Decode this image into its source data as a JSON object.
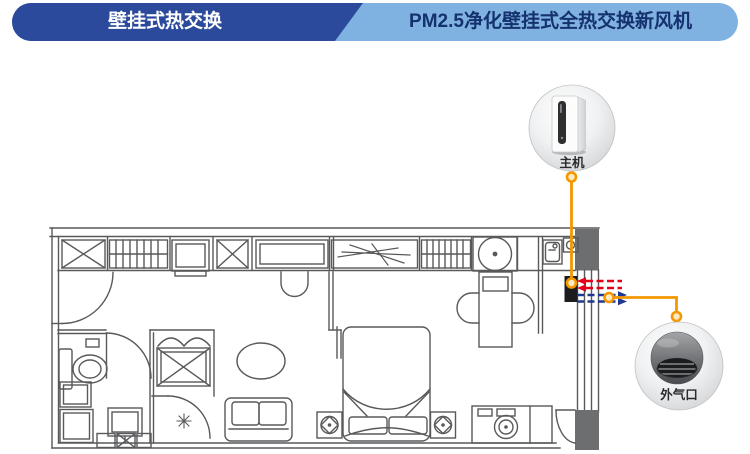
{
  "header": {
    "left_tab": {
      "label": "壁挂式热交换",
      "bg": "#2b4a9c",
      "text_color": "#ffffff"
    },
    "right_tab": {
      "label": "PM2.5净化壁挂式全热交换新风机",
      "bg": "#7fb2e1",
      "text_color": "#15316e"
    }
  },
  "callouts": {
    "main_unit": {
      "label": "主机",
      "icon": "fresh-air-unit-icon"
    },
    "outdoor_vent": {
      "label": "外气口",
      "icon": "dome-vent-icon"
    }
  },
  "diagram": {
    "type": "apartment-floor-plan",
    "plan_line_color": "#58595b",
    "wall_fill_color": "#6d6e70",
    "connector_color": "#f39800",
    "supply_air_color": "#e50019",
    "exhaust_air_color": "#20388f",
    "airflow": [
      {
        "name": "supply-air-arrows",
        "direction": "left-into-room",
        "color": "#e50019"
      },
      {
        "name": "exhaust-air-arrows",
        "direction": "right-to-outside",
        "color": "#20388f"
      }
    ]
  }
}
